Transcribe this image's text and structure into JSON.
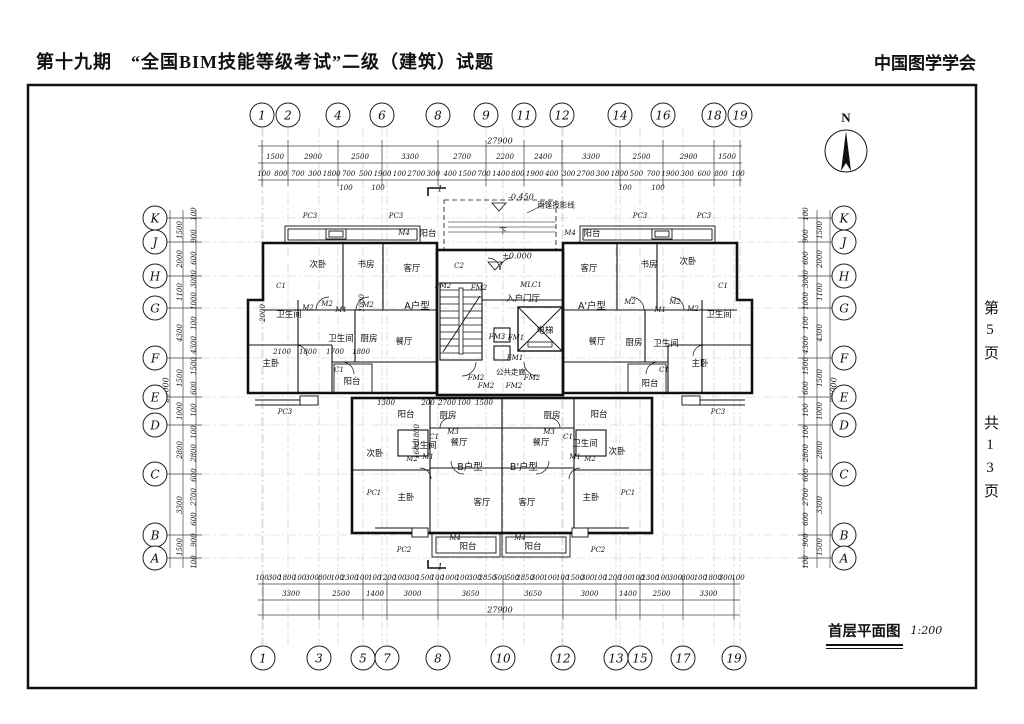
{
  "header": {
    "title": "第十九期　“全国BIM技能等级考试”二级（建筑）试题",
    "org": "中国图学学会"
  },
  "page_margin": {
    "current": "第5页",
    "total": "共13页"
  },
  "title_block": {
    "name": "首层平面图",
    "scale": "1:200"
  },
  "north": {
    "label": "N"
  },
  "grid": {
    "top": [
      {
        "label": "1",
        "x": 262
      },
      {
        "label": "2",
        "x": 288
      },
      {
        "label": "4",
        "x": 338
      },
      {
        "label": "6",
        "x": 382
      },
      {
        "label": "8",
        "x": 438
      },
      {
        "label": "9",
        "x": 486
      },
      {
        "label": "11",
        "x": 524
      },
      {
        "label": "12",
        "x": 562
      },
      {
        "label": "14",
        "x": 620
      },
      {
        "label": "16",
        "x": 663
      },
      {
        "label": "18",
        "x": 714
      },
      {
        "label": "19",
        "x": 740
      }
    ],
    "bottom": [
      {
        "label": "1",
        "x": 263
      },
      {
        "label": "3",
        "x": 319
      },
      {
        "label": "5",
        "x": 363
      },
      {
        "label": "7",
        "x": 387
      },
      {
        "label": "8",
        "x": 438
      },
      {
        "label": "10",
        "x": 503
      },
      {
        "label": "12",
        "x": 563
      },
      {
        "label": "13",
        "x": 616
      },
      {
        "label": "15",
        "x": 640
      },
      {
        "label": "17",
        "x": 683
      },
      {
        "label": "19",
        "x": 734
      }
    ],
    "left": [
      {
        "label": "K",
        "y": 218
      },
      {
        "label": "J",
        "y": 242
      },
      {
        "label": "H",
        "y": 276
      },
      {
        "label": "G",
        "y": 308
      },
      {
        "label": "F",
        "y": 358
      },
      {
        "label": "E",
        "y": 397
      },
      {
        "label": "D",
        "y": 425
      },
      {
        "label": "C",
        "y": 474
      },
      {
        "label": "B",
        "y": 535
      },
      {
        "label": "A",
        "y": 558
      }
    ],
    "right": [
      {
        "label": "K",
        "y": 218
      },
      {
        "label": "J",
        "y": 242
      },
      {
        "label": "H",
        "y": 276
      },
      {
        "label": "G",
        "y": 308
      },
      {
        "label": "F",
        "y": 358
      },
      {
        "label": "E",
        "y": 397
      },
      {
        "label": "D",
        "y": 425
      },
      {
        "label": "C",
        "y": 474
      },
      {
        "label": "B",
        "y": 535
      },
      {
        "label": "A",
        "y": 558
      }
    ]
  },
  "dims": {
    "top_total": {
      "v": "27900",
      "x": 500,
      "y": 141
    },
    "bottom_total": {
      "v": "27900",
      "x": 500,
      "y": 610
    },
    "left_total": {
      "v": "20000",
      "x": 166,
      "y": 390
    },
    "right_total": {
      "v": "20000",
      "x": 834,
      "y": 390
    },
    "top_major": [
      "1500",
      "2900",
      "2500",
      "3300",
      "2700",
      "2200",
      "2400",
      "3300",
      "2500",
      "2900",
      "1500"
    ],
    "bottom_major": [
      "3300",
      "2500",
      "1400",
      "3000",
      "3650",
      "3650",
      "3000",
      "1400",
      "2500",
      "3300"
    ],
    "left_major": [
      "1500",
      "2000",
      "1100",
      "4300",
      "1500",
      "1000",
      "2800",
      "3300",
      "1500"
    ],
    "right_major": [
      "1500",
      "2000",
      "1100",
      "4300",
      "1500",
      "1000",
      "2800",
      "3300",
      "1500"
    ],
    "top_minor": [
      "100",
      "800",
      "700",
      "300",
      "1800",
      "700",
      "500",
      "1900",
      "100",
      "2700",
      "300",
      "400",
      "1500",
      "700",
      "1400",
      "800",
      "1900",
      "400",
      "300",
      "2700",
      "300",
      "1800",
      "500",
      "700",
      "1900",
      "300",
      "600",
      "800",
      "100"
    ],
    "bottom_minor": [
      "100",
      "300",
      "1800",
      "100",
      "300",
      "800",
      "100",
      "2300",
      "100",
      "100",
      "1200",
      "100",
      "300",
      "1500",
      "100",
      "1000",
      "100",
      "300",
      "2850",
      "500",
      "500",
      "2850",
      "300",
      "100",
      "100",
      "1500",
      "300",
      "100",
      "1200",
      "100",
      "100",
      "2300",
      "100",
      "300",
      "800",
      "100",
      "1800",
      "300",
      "100"
    ],
    "left_minor": [
      "100",
      "900",
      "600",
      "3000",
      "1000",
      "100",
      "4300",
      "1500",
      "600",
      "100",
      "100",
      "2800",
      "600",
      "2700",
      "600",
      "900",
      "100"
    ],
    "right_minor": [
      "100",
      "900",
      "600",
      "3000",
      "1000",
      "100",
      "4300",
      "1500",
      "600",
      "100",
      "100",
      "2800",
      "600",
      "2700",
      "600",
      "900",
      "100"
    ],
    "top_sub": [
      {
        "v": "100",
        "x": 346,
        "y": 188
      },
      {
        "v": "100",
        "x": 378,
        "y": 188
      },
      {
        "v": "100",
        "x": 625,
        "y": 188
      },
      {
        "v": "100",
        "x": 658,
        "y": 188
      }
    ],
    "interior": [
      {
        "v": "2100",
        "x": 282,
        "y": 352
      },
      {
        "v": "1800",
        "x": 308,
        "y": 352
      },
      {
        "v": "1700",
        "x": 335,
        "y": 352
      },
      {
        "v": "1800",
        "x": 361,
        "y": 352
      },
      {
        "v": "1300",
        "x": 386,
        "y": 403
      },
      {
        "v": "200",
        "x": 428,
        "y": 403
      },
      {
        "v": "2700",
        "x": 447,
        "y": 403
      },
      {
        "v": "100",
        "x": 464,
        "y": 403
      },
      {
        "v": "1500",
        "x": 484,
        "y": 403
      },
      {
        "v": "2000",
        "x": 263,
        "y": 313,
        "r": 1
      },
      {
        "v": "1000",
        "x": 362,
        "y": 303,
        "r": 1
      },
      {
        "v": "1800",
        "x": 417,
        "y": 433,
        "r": 1
      },
      {
        "v": "1600",
        "x": 417,
        "y": 450,
        "r": 1
      }
    ]
  },
  "levels": [
    {
      "v": "-0.450",
      "x": 521,
      "y": 197
    },
    {
      "v": "±0.000",
      "x": 517,
      "y": 256
    }
  ],
  "annotations": [
    {
      "v": "雨篷投影线",
      "x": 556,
      "y": 205
    },
    {
      "v": "公共走廊",
      "x": 511,
      "y": 372
    },
    {
      "v": "下",
      "x": 503,
      "y": 231
    }
  ],
  "section_marks": [
    {
      "v": "1",
      "x": 440,
      "y": 189
    },
    {
      "v": "1",
      "x": 440,
      "y": 567
    }
  ],
  "rooms": [
    {
      "label": "次卧",
      "x": 318,
      "y": 264
    },
    {
      "label": "书房",
      "x": 366,
      "y": 264
    },
    {
      "label": "客厅",
      "x": 412,
      "y": 268
    },
    {
      "label": "阳台",
      "x": 428,
      "y": 233
    },
    {
      "label": "A户型",
      "x": 417,
      "y": 305,
      "unit": 1
    },
    {
      "label": "卫生间",
      "x": 289,
      "y": 314
    },
    {
      "label": "卫生间",
      "x": 341,
      "y": 338
    },
    {
      "label": "厨房",
      "x": 369,
      "y": 338
    },
    {
      "label": "餐厅",
      "x": 404,
      "y": 341
    },
    {
      "label": "主卧",
      "x": 271,
      "y": 363
    },
    {
      "label": "阳台",
      "x": 352,
      "y": 381
    },
    {
      "label": "客厅",
      "x": 589,
      "y": 268
    },
    {
      "label": "书房",
      "x": 649,
      "y": 264
    },
    {
      "label": "次卧",
      "x": 688,
      "y": 261
    },
    {
      "label": "阳台",
      "x": 592,
      "y": 233
    },
    {
      "label": "A'户型",
      "x": 592,
      "y": 305,
      "unit": 1
    },
    {
      "label": "餐厅",
      "x": 597,
      "y": 341
    },
    {
      "label": "厨房",
      "x": 634,
      "y": 342
    },
    {
      "label": "卫生间",
      "x": 666,
      "y": 343
    },
    {
      "label": "卫生间",
      "x": 719,
      "y": 314
    },
    {
      "label": "主卧",
      "x": 700,
      "y": 363
    },
    {
      "label": "阳台",
      "x": 650,
      "y": 383
    },
    {
      "label": "入户门厅",
      "x": 523,
      "y": 298
    },
    {
      "label": "电梯",
      "x": 545,
      "y": 330
    },
    {
      "label": "阳台",
      "x": 406,
      "y": 414
    },
    {
      "label": "厨房",
      "x": 448,
      "y": 415
    },
    {
      "label": "餐厅",
      "x": 459,
      "y": 442
    },
    {
      "label": "卫生间",
      "x": 424,
      "y": 445
    },
    {
      "label": "次卧",
      "x": 375,
      "y": 453
    },
    {
      "label": "B户型",
      "x": 470,
      "y": 466,
      "unit": 1
    },
    {
      "label": "客厅",
      "x": 482,
      "y": 502
    },
    {
      "label": "主卧",
      "x": 406,
      "y": 497
    },
    {
      "label": "阳台",
      "x": 468,
      "y": 546
    },
    {
      "label": "阳台",
      "x": 599,
      "y": 414
    },
    {
      "label": "厨房",
      "x": 552,
      "y": 415
    },
    {
      "label": "餐厅",
      "x": 541,
      "y": 442
    },
    {
      "label": "卫生间",
      "x": 585,
      "y": 443
    },
    {
      "label": "次卧",
      "x": 617,
      "y": 451
    },
    {
      "label": "B'户型",
      "x": 524,
      "y": 466,
      "unit": 1
    },
    {
      "label": "客厅",
      "x": 527,
      "y": 502
    },
    {
      "label": "主卧",
      "x": 591,
      "y": 497
    },
    {
      "label": "阳台",
      "x": 533,
      "y": 546
    }
  ],
  "tags": [
    {
      "v": "PC3",
      "x": 310,
      "y": 216
    },
    {
      "v": "PC3",
      "x": 396,
      "y": 216
    },
    {
      "v": "PC3",
      "x": 640,
      "y": 216
    },
    {
      "v": "PC3",
      "x": 704,
      "y": 216
    },
    {
      "v": "PC3",
      "x": 285,
      "y": 412
    },
    {
      "v": "PC3",
      "x": 718,
      "y": 412
    },
    {
      "v": "PC1",
      "x": 374,
      "y": 493
    },
    {
      "v": "PC1",
      "x": 628,
      "y": 493
    },
    {
      "v": "PC2",
      "x": 404,
      "y": 550
    },
    {
      "v": "PC2",
      "x": 598,
      "y": 550
    },
    {
      "v": "M4",
      "x": 404,
      "y": 233
    },
    {
      "v": "M4",
      "x": 570,
      "y": 233
    },
    {
      "v": "M4",
      "x": 455,
      "y": 538
    },
    {
      "v": "M4",
      "x": 520,
      "y": 538
    },
    {
      "v": "C1",
      "x": 281,
      "y": 286
    },
    {
      "v": "C1",
      "x": 723,
      "y": 286
    },
    {
      "v": "C1",
      "x": 339,
      "y": 370
    },
    {
      "v": "C1",
      "x": 664,
      "y": 370
    },
    {
      "v": "C1",
      "x": 434,
      "y": 437
    },
    {
      "v": "C1",
      "x": 568,
      "y": 437
    },
    {
      "v": "C2",
      "x": 459,
      "y": 266
    },
    {
      "v": "M2",
      "x": 308,
      "y": 308
    },
    {
      "v": "M2",
      "x": 327,
      "y": 304
    },
    {
      "v": "M2",
      "x": 368,
      "y": 305
    },
    {
      "v": "M2",
      "x": 630,
      "y": 302
    },
    {
      "v": "M2",
      "x": 675,
      "y": 302
    },
    {
      "v": "M2",
      "x": 693,
      "y": 309
    },
    {
      "v": "M2",
      "x": 412,
      "y": 459
    },
    {
      "v": "M2",
      "x": 590,
      "y": 459
    },
    {
      "v": "M1",
      "x": 341,
      "y": 310
    },
    {
      "v": "M1",
      "x": 660,
      "y": 310
    },
    {
      "v": "M1",
      "x": 428,
      "y": 457
    },
    {
      "v": "M1",
      "x": 575,
      "y": 457
    },
    {
      "v": "M3",
      "x": 453,
      "y": 432
    },
    {
      "v": "M3",
      "x": 549,
      "y": 432
    },
    {
      "v": "MLC1",
      "x": 531,
      "y": 285
    },
    {
      "v": "FM3",
      "x": 497,
      "y": 337
    },
    {
      "v": "FM1",
      "x": 516,
      "y": 338
    },
    {
      "v": "FM1",
      "x": 515,
      "y": 358
    },
    {
      "v": "FM2",
      "x": 443,
      "y": 286
    },
    {
      "v": "FM2",
      "x": 479,
      "y": 288
    },
    {
      "v": "FM2",
      "x": 476,
      "y": 378
    },
    {
      "v": "FM2",
      "x": 532,
      "y": 378
    },
    {
      "v": "FM2",
      "x": 486,
      "y": 386
    },
    {
      "v": "FM2",
      "x": 514,
      "y": 386
    }
  ]
}
